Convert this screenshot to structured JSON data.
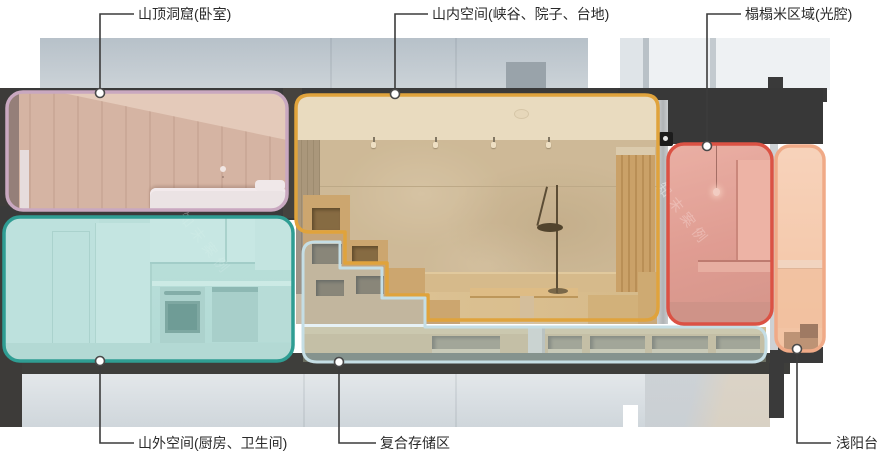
{
  "diagram": {
    "type": "architectural-section-annotation",
    "leader_line_color": "#3c3c3c",
    "labels": [
      {
        "id": "bedroom-cave",
        "text": "山顶洞窟(卧室)",
        "color": "#c9a8c0"
      },
      {
        "id": "inner-space",
        "text": "山内空间(峡谷、院子、台地)",
        "color": "#e0a33c"
      },
      {
        "id": "tatami-area",
        "text": "榻榻米区域(光腔)",
        "color": "#db5244"
      },
      {
        "id": "outer-space",
        "text": "山外空间(厨房、卫生间)",
        "color": "#2f9d93"
      },
      {
        "id": "storage-zone",
        "text": "复合存储区",
        "color": "#c5dee5"
      },
      {
        "id": "balcony",
        "text": "浅阳台",
        "color": "#f0aa87"
      }
    ],
    "watermark": {
      "text": "知末案例"
    }
  }
}
